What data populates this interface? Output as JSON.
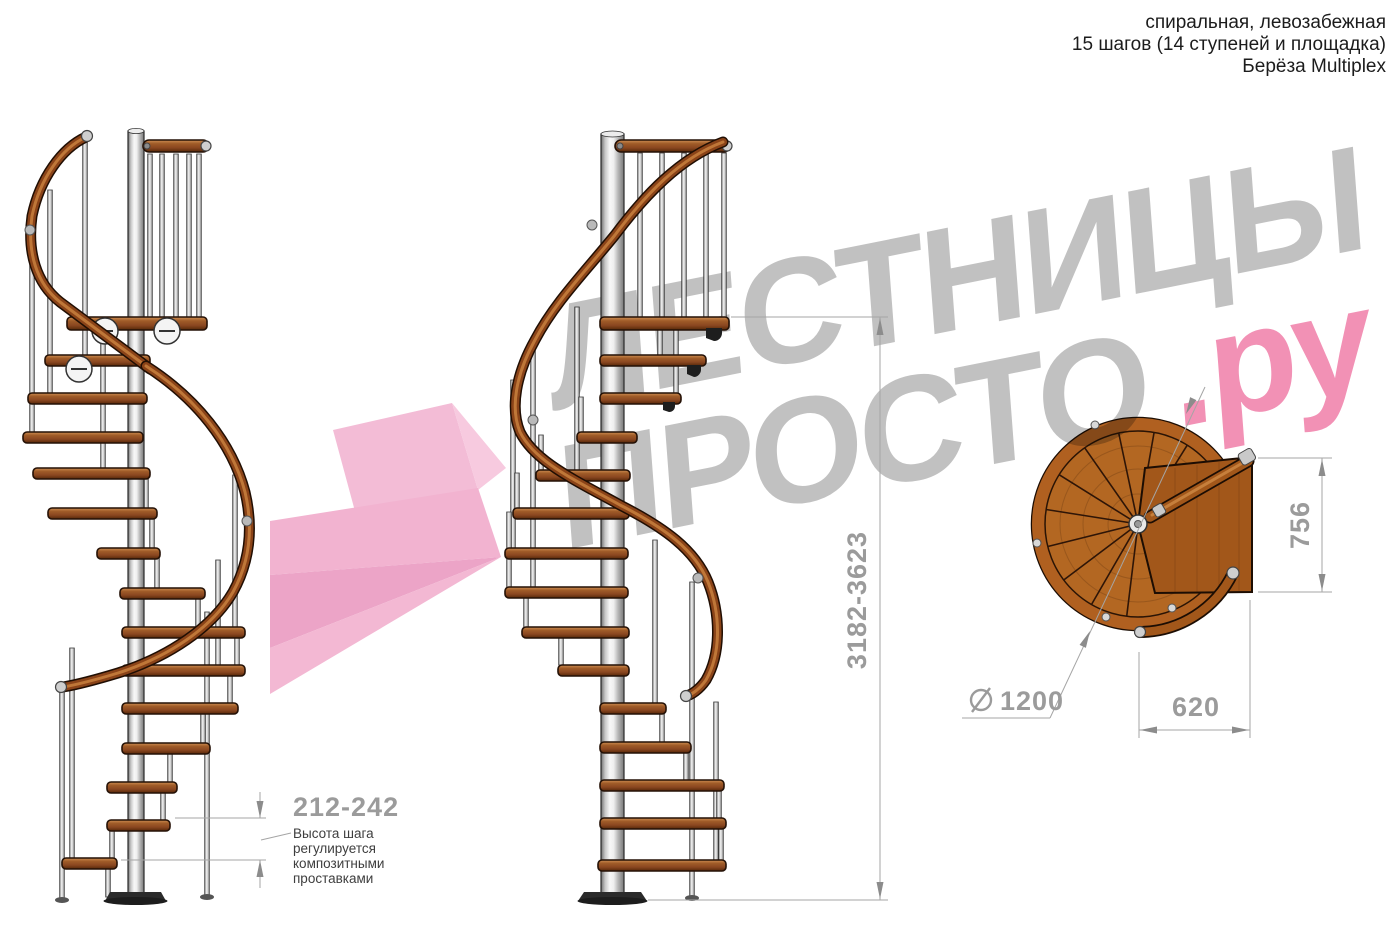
{
  "header": {
    "line1": "спиральная, левозабежная",
    "line2": "15 шагов (14 ступеней и площадка)",
    "line3": "Берёза Multiplex"
  },
  "watermark": {
    "word1": "ЛЕСТНИЦЫ",
    "word2": "ПРОСТО",
    "suffix": ".ру"
  },
  "dimensions": {
    "total_height": "3182-3623",
    "step_height": "212-242",
    "note_line1": "Высота шага",
    "note_line2": "регулируется",
    "note_line3": "композитными",
    "note_line4": "проставками",
    "plan_width": "756",
    "plan_depth": "620",
    "diameter_value": "1200"
  },
  "colors": {
    "wood_dark": "#8a4720",
    "wood_light": "#c1813f",
    "metal_pole": "#d9d9d9",
    "dimension_gray": "#9b9b9b",
    "watermark_gray": "#c1c1c1",
    "watermark_pink": "#f291b5",
    "arrow_pink": "#efaacb"
  }
}
